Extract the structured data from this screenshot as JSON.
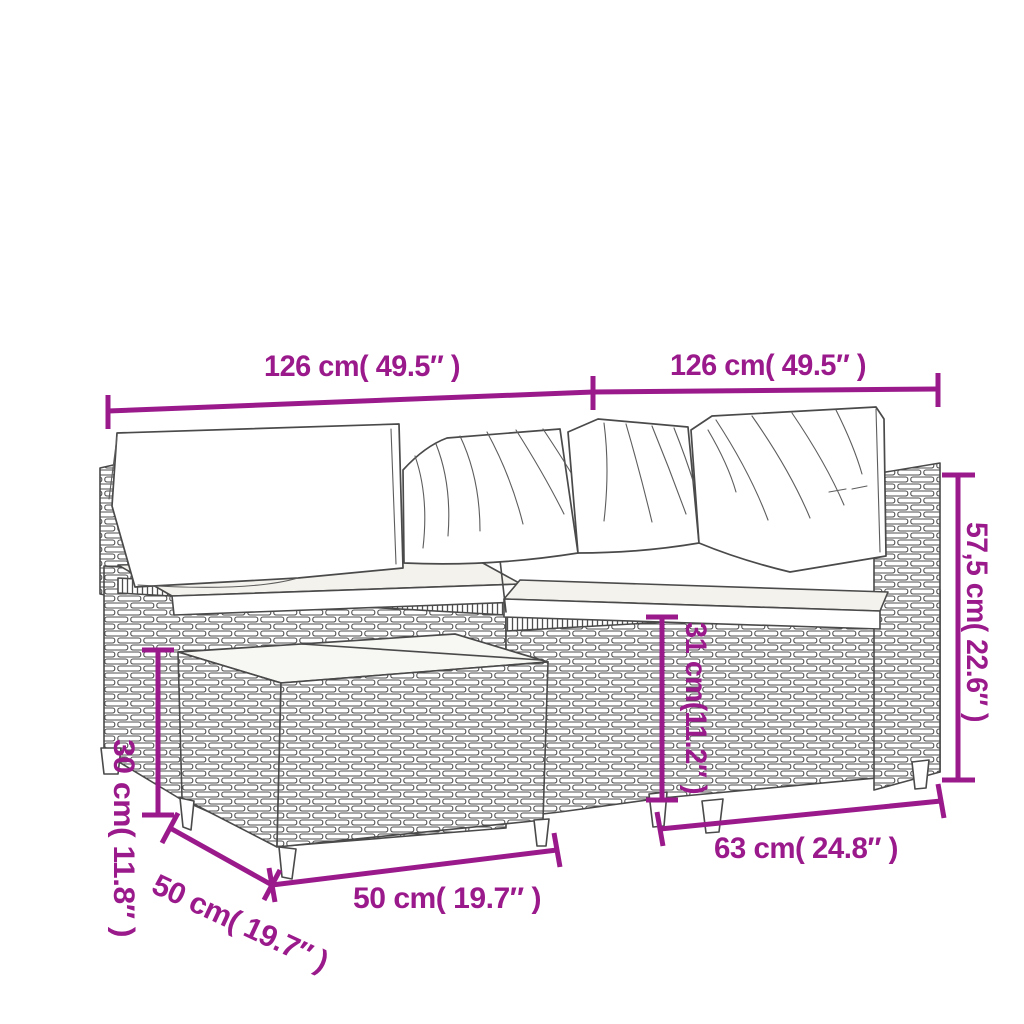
{
  "colors": {
    "dimension_accent": "#9a1a8c",
    "line_art": "#4a4a4a",
    "background": "#ffffff"
  },
  "diagram": {
    "type": "product-dimension-diagram",
    "subject": "poly rattan garden corner sofa set with cushions and coffee table (line-art sketch)",
    "units": [
      "cm",
      "inches"
    ],
    "dimensions": [
      {
        "id": "sofa-left-section-width",
        "label": "126 cm( 49.5″ )",
        "orientation": "horizontal",
        "cm": 126,
        "inches": 49.5
      },
      {
        "id": "sofa-right-section-width",
        "label": "126 cm( 49.5″ )",
        "orientation": "horizontal",
        "cm": 126,
        "inches": 49.5
      },
      {
        "id": "sofa-total-height",
        "label": "57,5 cm( 22.6″ )",
        "orientation": "vertical",
        "cm": 57.5,
        "inches": 22.6
      },
      {
        "id": "sofa-seat-height",
        "label": "31 cm(11.2″ )",
        "orientation": "vertical",
        "cm": 31,
        "inches": 11.2
      },
      {
        "id": "sofa-seat-depth",
        "label": "63 cm( 24.8″ )",
        "orientation": "horizontal",
        "cm": 63,
        "inches": 24.8
      },
      {
        "id": "table-width",
        "label": "50 cm( 19.7″ )",
        "orientation": "horizontal",
        "cm": 50,
        "inches": 19.7
      },
      {
        "id": "table-depth",
        "label": "50 cm( 19.7″ )",
        "orientation": "diagonal",
        "cm": 50,
        "inches": 19.7
      },
      {
        "id": "table-height",
        "label": "30 cm( 11.8″ )",
        "orientation": "vertical",
        "cm": 30,
        "inches": 11.8
      }
    ]
  }
}
